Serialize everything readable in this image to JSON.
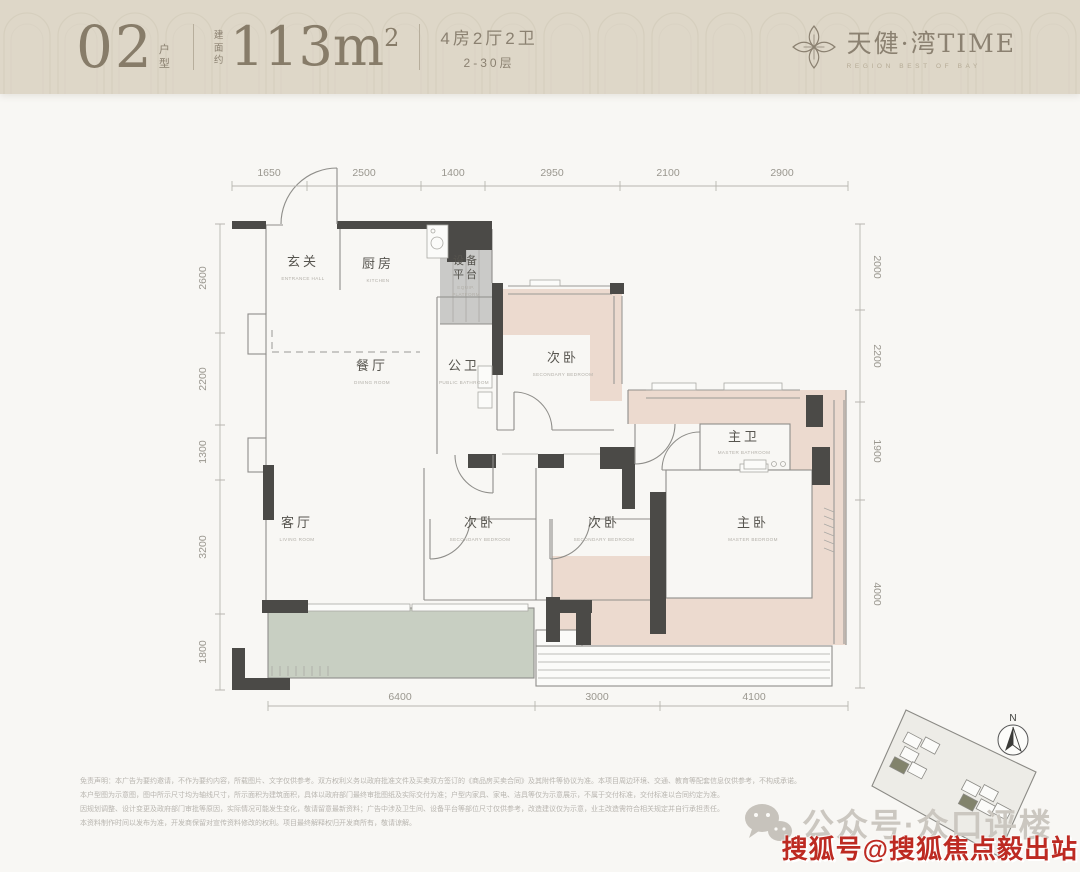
{
  "colors": {
    "header_bg": "#ded7c8",
    "wall": "#4b4a47",
    "bedroom_pink": "#ecdacf",
    "balcony_green": "#c8cfc2",
    "equip_gray": "#cacac8",
    "red_watermark": "#bd2a22"
  },
  "header": {
    "unit": "02",
    "unit_suffix": "户型",
    "area_prefix": "建面约",
    "area": "113m",
    "area_sup": "2",
    "spec": "4房2厅2卫",
    "floors": "2-30层",
    "brand": "天健·湾TIME",
    "brand_tagline": "REGION BEST OF BAY"
  },
  "plan": {
    "rooms": [
      {
        "cn": "玄关",
        "en": "ENTRANCE HALL"
      },
      {
        "cn": "厨房",
        "en": "KITCHEN"
      },
      {
        "cn_a": "设备",
        "cn_b": "平台",
        "en_a": "EQUIP.",
        "en_b": "PLATFORM"
      },
      {
        "cn": "餐厅",
        "en": "DINING ROOM"
      },
      {
        "cn": "公卫",
        "en": "PUBLIC BATHROOM"
      },
      {
        "cn": "次卧",
        "en": "SECONDARY BEDROOM"
      },
      {
        "cn": "主卫",
        "en": "MASTER BATHROOM"
      },
      {
        "cn": "客厅",
        "en": "LIVING ROOM"
      },
      {
        "cn": "次卧",
        "en": "SECONDARY BEDROOM"
      },
      {
        "cn": "次卧",
        "en": "SECONDARY BEDROOM"
      },
      {
        "cn": "主卧",
        "en": "MASTER BEDROOM"
      }
    ],
    "dims": {
      "top": [
        "1650",
        "2500",
        "1400",
        "2950",
        "2100",
        "2900"
      ],
      "left": [
        "2600",
        "2200",
        "1300",
        "3200",
        "1800"
      ],
      "right": [
        "2000",
        "2200",
        "1900",
        "4000"
      ],
      "bottom": [
        "6400",
        "3000",
        "4100"
      ]
    }
  },
  "sitemap": {
    "compass_n": "N"
  },
  "watermarks": {
    "wechat_label": "公众号·众口评楼",
    "sohu_label": "搜狐号@搜狐焦点毅出站"
  },
  "disclaimer": {
    "lines": [
      "免责声明：本广告为要约邀请，不作为要约内容，所载图片、文字仅供参考。双方权利义务以政府批准文件及买卖双方签订的《商品房买卖合同》及其附件等协议为准。本项目周边环境、交通、教育等配套信息仅供参考，不构成承诺。",
      "本户型图为示意图，图中所示尺寸均为轴线尺寸，所示面积为建筑面积，具体以政府部门最终审批图纸及实际交付为准；户型内家具、家电、洁具等仅为示意展示，不属于交付标准，交付标准以合同约定为准。",
      "因规划调整、设计变更及政府部门审批等原因，实际情况可能发生变化，敬请留意最新资料；广告中涉及卫生间、设备平台等部位尺寸仅供参考，改造建议仅为示意，业主改造需符合相关规定并自行承担责任。",
      "本资料制作时间以发布为准，开发商保留对宣传资料修改的权利。项目最终解释权归开发商所有，敬请谅解。"
    ]
  }
}
